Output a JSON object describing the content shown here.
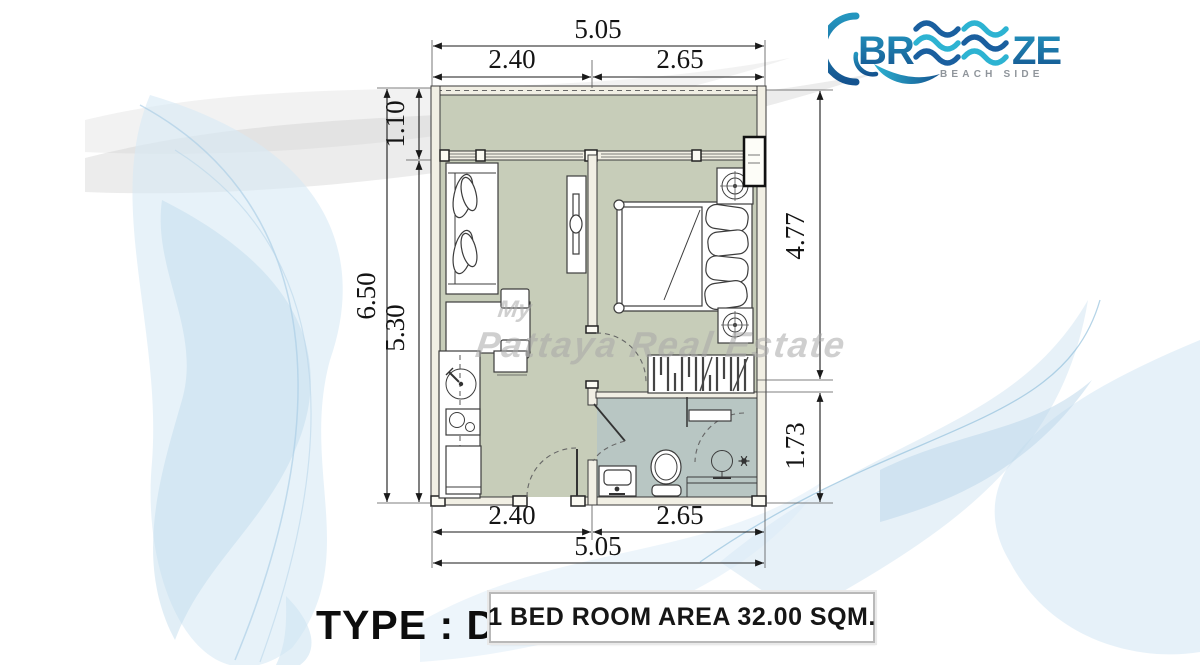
{
  "logo": {
    "brand": "BREEZE",
    "brand_left": "BR",
    "brand_right": "ZE",
    "tagline": "BEACH SIDE"
  },
  "watermark": {
    "small": "My",
    "large": "Pattaya Real Estate"
  },
  "dimensions": {
    "top_total": "5.05",
    "top_left": "2.40",
    "top_right": "2.65",
    "left_total": "6.50",
    "left_upper": "1.10",
    "left_lower": "5.30",
    "right_upper": "4.77",
    "right_lower": "1.73",
    "bottom_left": "2.40",
    "bottom_right": "2.65",
    "bottom_total": "5.05"
  },
  "footer": {
    "type_label": "TYPE : D",
    "area_label": "1 BED ROOM AREA 32.00 SQM."
  },
  "colors": {
    "floor_green": "#c7cdb9",
    "bathroom_floor": "#b8c6c3",
    "wall_fill": "#f1efe4",
    "wall_outline": "#3a3a3a",
    "dimension_text": "#141414",
    "brand_blue": "#1a5f9f",
    "brand_teal": "#2db3d2",
    "tagline_gray": "#8f959b",
    "wave_light_blue": "#d7e9f5"
  }
}
